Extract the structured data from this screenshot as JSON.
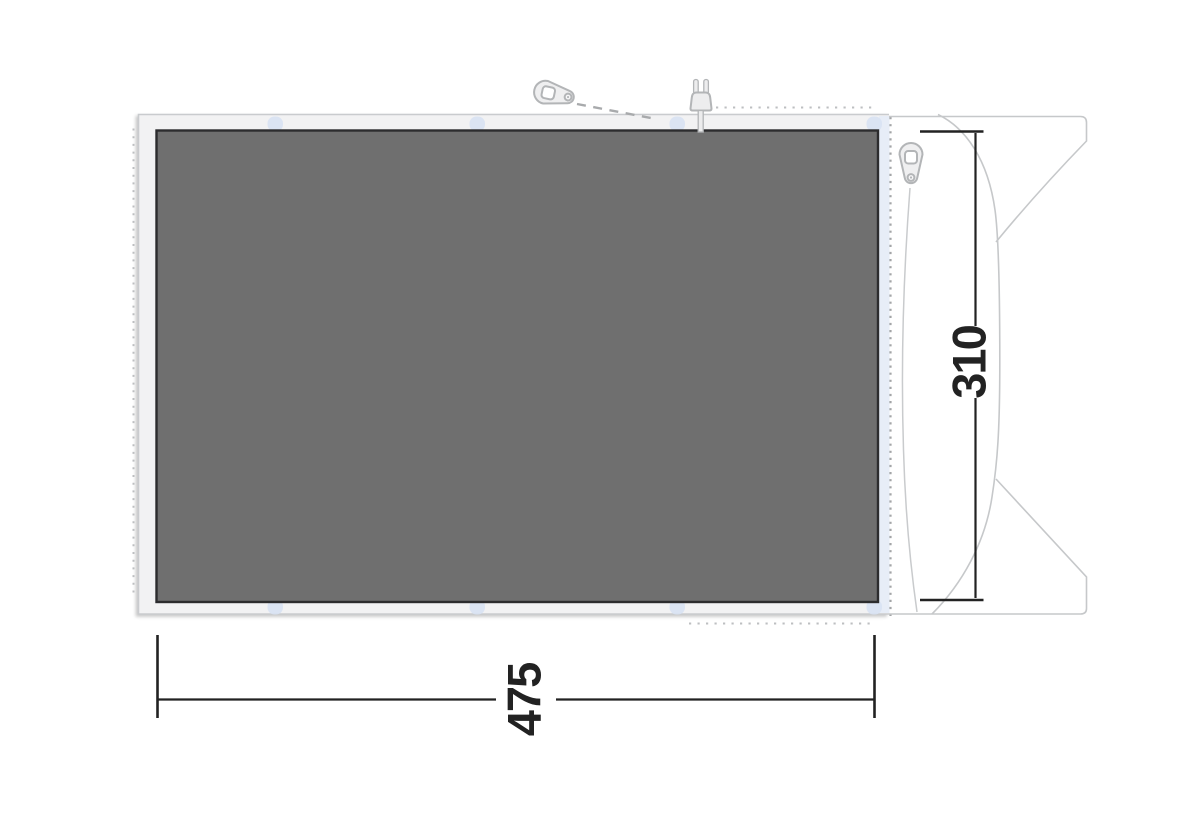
{
  "diagram": {
    "kind": "tent-footprint-dimension-drawing",
    "dimension_labels": {
      "width": "475",
      "depth": "310"
    },
    "icons": {
      "top": "zipper-pull-icon",
      "right": "zipper-pull-icon",
      "plug": "power-plug-icon"
    },
    "colors": {
      "groundsheet_fill": "#6f6f6f",
      "groundsheet_border": "#2c2c2e",
      "footprint_fill": "#f2f2f3",
      "footprint_border": "#c9cbce",
      "tab_blue": "#d8e2f3",
      "zipper_band_blue": "#e7edf7",
      "outline_gray": "#c6c8ca",
      "cord_gray": "#c9cbcd",
      "dotted_gray": "#bdbfc1",
      "dotted_dark_gray": "#a3a5a7",
      "icon_stroke": "#b3b5b7",
      "icon_fill": "#efeff0",
      "dimension_ink": "#222222"
    }
  }
}
